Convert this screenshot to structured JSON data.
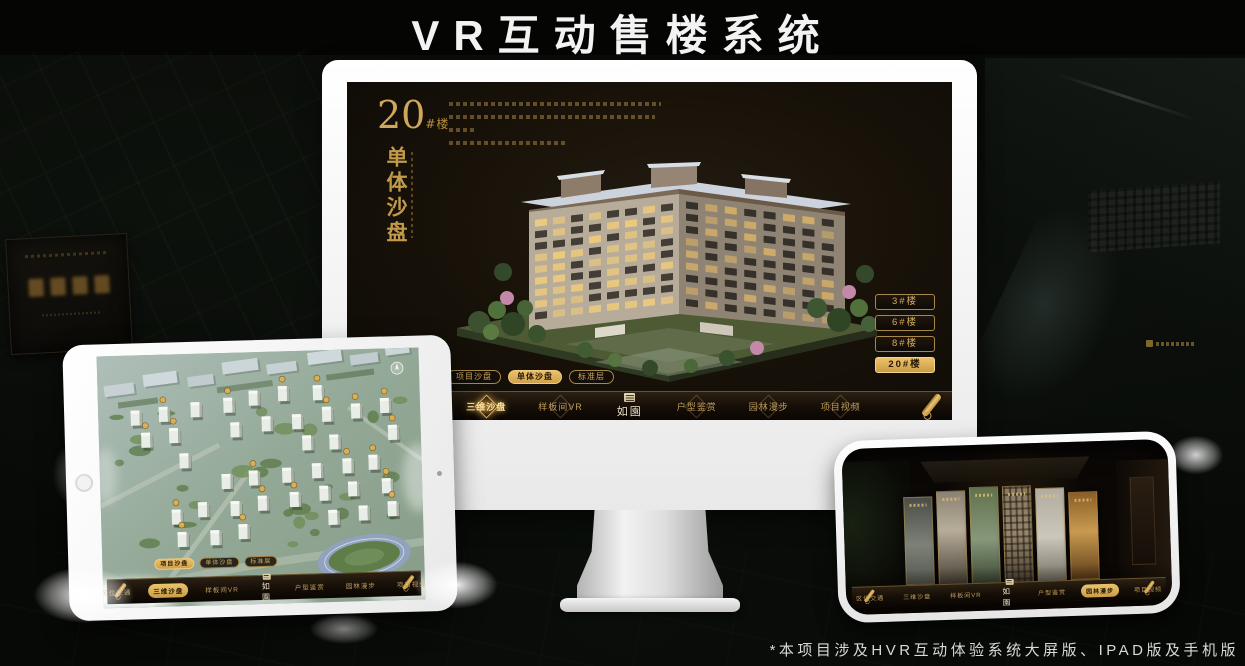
{
  "page": {
    "title": "VR互动售楼系统",
    "footnote": "*本项目涉及HVR互动体验系统大屏版、IPAD版及手机版"
  },
  "nav": {
    "logo": "如園",
    "items": [
      "区位交通",
      "三维沙盘",
      "样板间VR",
      "户型鉴赏",
      "园林漫步",
      "项目视频"
    ]
  },
  "pills": [
    "项目沙盘",
    "单体沙盘",
    "标准层"
  ],
  "monitor": {
    "block_number": "20",
    "block_suffix": "#楼",
    "block_subtitle": "单体沙盘",
    "floor_buttons": [
      "3#楼",
      "6#楼",
      "8#楼",
      "20#楼"
    ],
    "active_floor": "20#楼",
    "active_pill": "单体沙盘",
    "active_nav": "三维沙盘"
  },
  "tablet": {
    "active_pill": "项目沙盘",
    "active_nav": "三维沙盘"
  },
  "phone": {
    "active_nav": "园林漫步"
  },
  "colors": {
    "gold": "#d2ab5e",
    "gold_active": "#ecc069",
    "screen_bg": "#15100a"
  }
}
